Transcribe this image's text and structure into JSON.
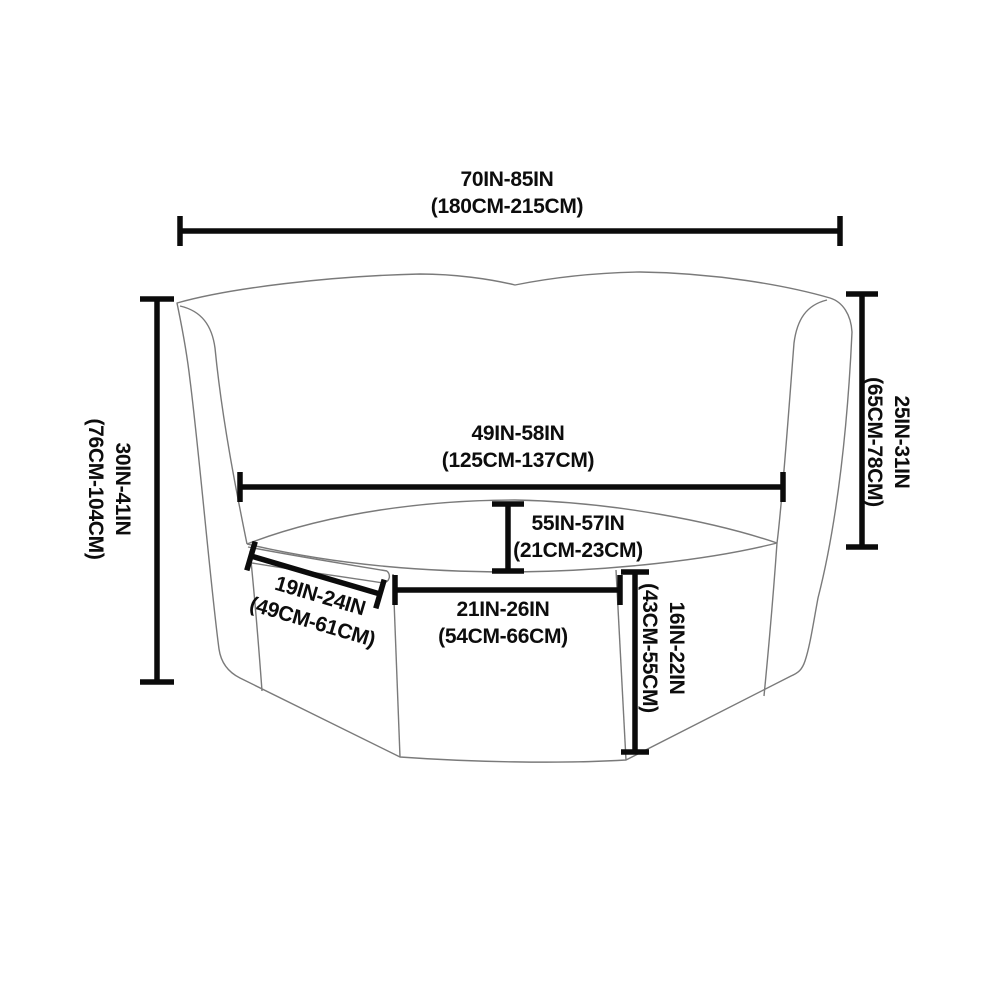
{
  "colors": {
    "background": "#ffffff",
    "dimension_line": "#0b0b0b",
    "sofa_outline": "#7a7a7a",
    "label_text": "#0d0d0d"
  },
  "diagram": {
    "type": "sofa-cover-size-diagram"
  },
  "dimensions": {
    "total_width": {
      "inches": "70IN-85IN",
      "centimeters": "(180CM-215CM)"
    },
    "back_height_left": {
      "inches": "30IN-41IN",
      "centimeters": "(76CM-104CM)"
    },
    "back_height_right": {
      "inches": "25IN-31IN",
      "centimeters": "(65CM-78CM)"
    },
    "back_width": {
      "inches": "49IN-58IN",
      "centimeters": "(125CM-137CM)"
    },
    "back_to_seat_depth": {
      "inches": "55IN-57IN",
      "centimeters": "(21CM-23CM)"
    },
    "left_front_panel_width": {
      "inches": "19IN-24IN",
      "centimeters": "(49CM-61CM)"
    },
    "front_panel_width": {
      "inches": "21IN-26IN",
      "centimeters": "(54CM-66CM)"
    },
    "front_panel_height": {
      "inches": "16IN-22IN",
      "centimeters": "(43CM-55CM)"
    }
  }
}
